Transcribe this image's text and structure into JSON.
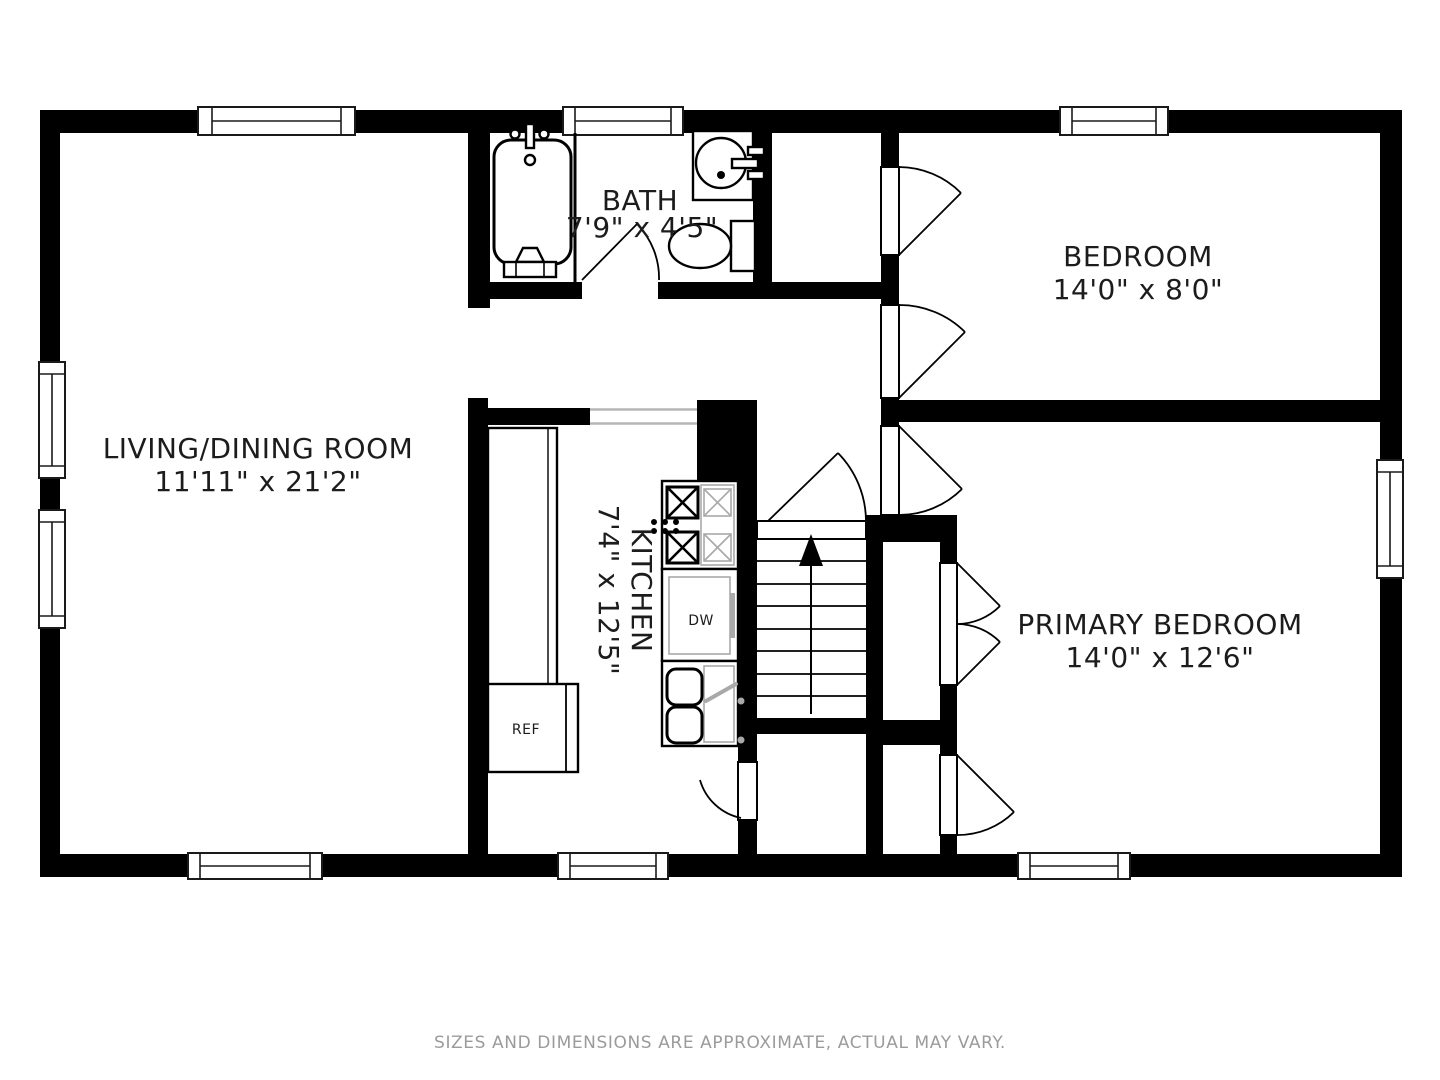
{
  "floorplan": {
    "rooms": {
      "living": {
        "name": "LIVING/DINING ROOM",
        "dims": "11'11\" x 21'2\""
      },
      "bath": {
        "name": "BATH",
        "dims": "7'9\" x 4'5\""
      },
      "bedroom": {
        "name": "BEDROOM",
        "dims": "14'0\" x 8'0\""
      },
      "kitchen": {
        "name": "KITCHEN",
        "dims": "7'4\" x 12'5\""
      },
      "primary": {
        "name": "PRIMARY BEDROOM",
        "dims": "14'0\" x 12'6\""
      }
    },
    "appliances": {
      "refrigerator": "REF",
      "dishwasher": "DW"
    },
    "footer": "SIZES AND DIMENSIONS ARE APPROXIMATE, ACTUAL MAY VARY.",
    "colors": {
      "wall": "#000000",
      "background": "#ffffff",
      "footer_text": "#9b9b9b",
      "fixture_gray": "#a9a9a9"
    }
  }
}
